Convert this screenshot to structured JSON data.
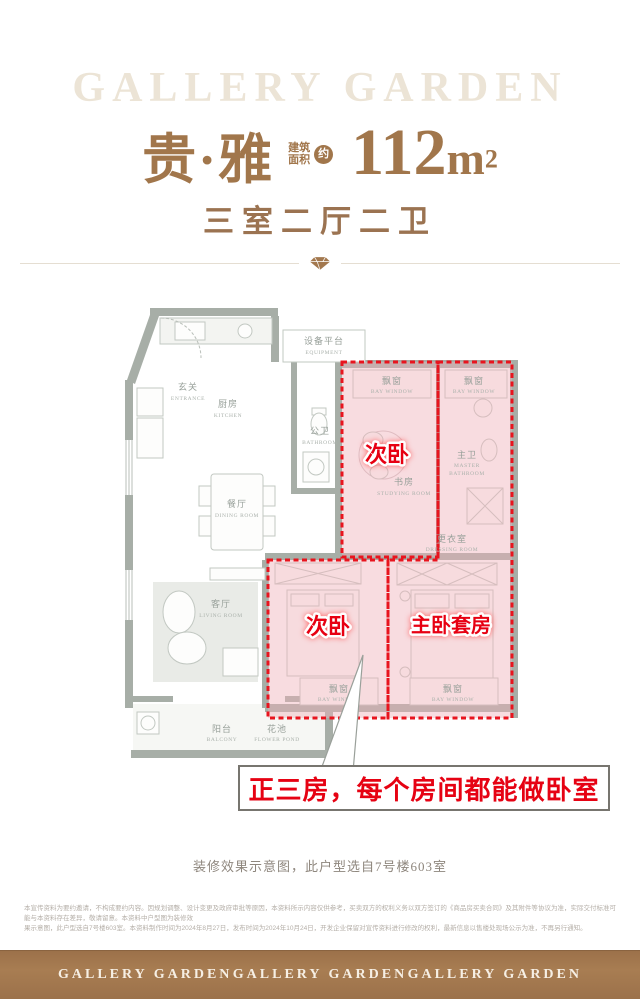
{
  "brand": {
    "watermark": "GALLERY GARDEN",
    "footer_logos": [
      "GALLERY GARDEN",
      "GALLERY GARDEN",
      "GALLERY GARDEN"
    ]
  },
  "header": {
    "apartment_name": "贵·雅",
    "area_label_line1": "建筑",
    "area_label_line2": "面积",
    "approx_badge": "约",
    "area_value": "112",
    "area_unit": "m",
    "area_sup": "2",
    "layout_spec": "三室二厅二卫"
  },
  "floorplan": {
    "rooms": {
      "entrance": {
        "cn": "玄关",
        "en": "ENTRANCE"
      },
      "kitchen": {
        "cn": "厨房",
        "en": "KITCHEN"
      },
      "equipment": {
        "cn": "设备平台",
        "en": "EQUIPMENT"
      },
      "public_bath": {
        "cn": "公卫",
        "en": "BATHROOM"
      },
      "dining": {
        "cn": "餐厅",
        "en": "DINING ROOM"
      },
      "living": {
        "cn": "客厅",
        "en": "LIVING ROOM"
      },
      "balcony": {
        "cn": "阳台",
        "en": "BALCONY"
      },
      "flower_pond": {
        "cn": "花池",
        "en": "FLOWER POND"
      },
      "study": {
        "cn": "书房",
        "en": "STUDYING ROOM"
      },
      "master_bath": {
        "cn": "主卫",
        "en_line1": "MASTER",
        "en_line2": "BATHROOM"
      },
      "dressing": {
        "cn": "更衣室",
        "en": "DRESSING ROOM"
      },
      "bay_window": {
        "cn": "飘窗",
        "en": "BAY WINDOW"
      }
    },
    "highlights": {
      "second_bedroom_1": "次卧",
      "second_bedroom_2": "次卧",
      "master_suite": "主卧套房"
    },
    "callout_text": "正三房，每个房间都能做卧室"
  },
  "caption": "装修效果示意图，此户型选自7号楼603室",
  "disclaimer": {
    "line1": "本宣传资料为要约邀请，不构成要约内容。因规划调整、设计变更及政府审批等原因，本资料所示内容仅供参考，买卖双方的权利义务以双方签订的《商品房买卖合同》及其附件等协议为准，实际交付标准可能与本资料存在差异，敬请留意。本资料中户型图为装修效",
    "line2": "果示意图，此户型选自7号楼603室。本资料制作时间为2024年8月27日，发布时间为2024年10月24日，开发企业保留对宣传资料进行修改的权利，最新信息以售楼处现场公示为准，不再另行通知。"
  },
  "colors": {
    "brand_brown": "#a1764b",
    "footer_brown": "#a2774d",
    "highlight_red": "#e70012",
    "dashed_red": "#e8141e",
    "highlight_pink": "#f7d9dd",
    "wall_gray": "#a7aea7",
    "watermark_beige": "#ece4d6"
  }
}
